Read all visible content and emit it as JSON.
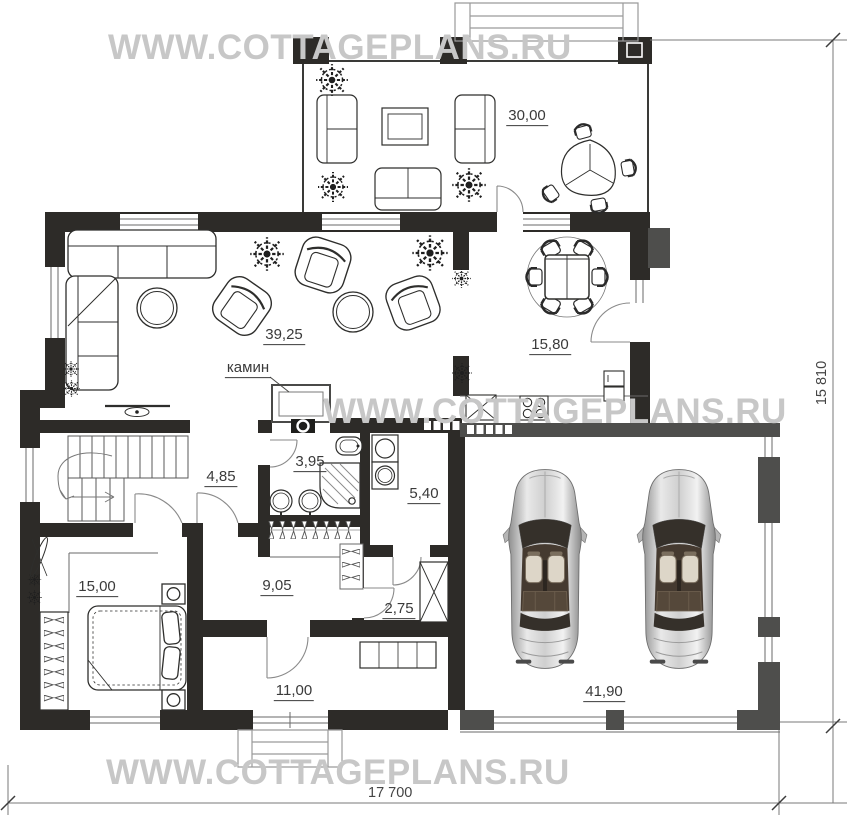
{
  "watermark": {
    "text": "WWW.COTTAGEPLANS.RU"
  },
  "dimensions": {
    "width": "17 700",
    "height": "15 810"
  },
  "annotations": {
    "fireplace": "камин"
  },
  "rooms": {
    "terrace": "30,00",
    "living_room": "39,25",
    "dining_kitchen": "15,80",
    "stair_hall": "4,85",
    "bathroom": "3,95",
    "utility": "5,40",
    "bedroom": "15,00",
    "corridor": "9,05",
    "vestibule": "2,75",
    "entry_hall": "11,00",
    "garage": "41,90"
  },
  "colors": {
    "wall": "#2d2b28",
    "garage_wall": "#4e4e4c",
    "watermark": "#c7c7c7"
  }
}
